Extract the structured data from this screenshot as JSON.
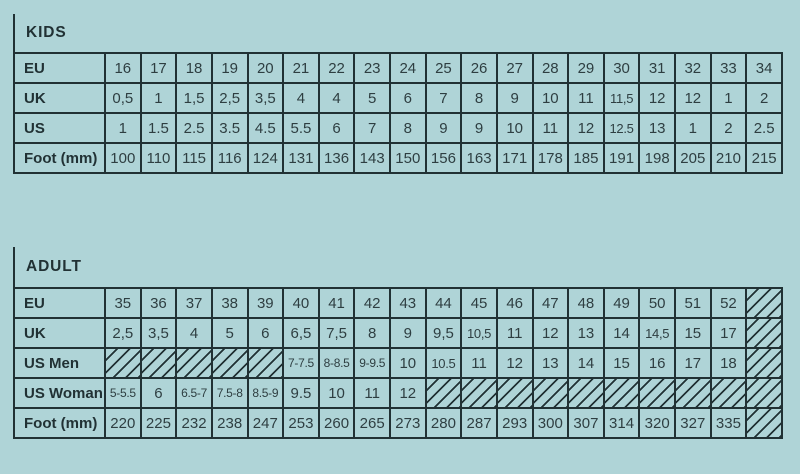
{
  "page": {
    "background_color": "#afd4d7",
    "ink_color": "#213134",
    "number_color": "#2e3e41",
    "hatch_pattern": "diagonal-lines"
  },
  "chart_data": [
    {
      "type": "table",
      "title": "KIDS",
      "rows": [
        {
          "label": "EU",
          "cells": [
            "16",
            "17",
            "18",
            "19",
            "20",
            "21",
            "22",
            "23",
            "24",
            "25",
            "26",
            "27",
            "28",
            "29",
            "30",
            "31",
            "32",
            "33",
            "34"
          ]
        },
        {
          "label": "UK",
          "cells": [
            "0,5",
            "1",
            "1,5",
            "2,5",
            "3,5",
            "4",
            "4",
            "5",
            "6",
            "7",
            "8",
            "9",
            "10",
            "11",
            "11,5",
            "12",
            "12",
            "1",
            "2"
          ]
        },
        {
          "label": "US",
          "cells": [
            "1",
            "1.5",
            "2.5",
            "3.5",
            "4.5",
            "5.5",
            "6",
            "7",
            "8",
            "9",
            "9",
            "10",
            "11",
            "12",
            "12.5",
            "13",
            "1",
            "2",
            "2.5"
          ]
        },
        {
          "label": "Foot (mm)",
          "cells": [
            "100",
            "110",
            "115",
            "116",
            "124",
            "131",
            "136",
            "143",
            "150",
            "156",
            "163",
            "171",
            "178",
            "185",
            "191",
            "198",
            "205",
            "210",
            "215"
          ]
        }
      ]
    },
    {
      "type": "table",
      "title": "ADULT",
      "rows": [
        {
          "label": "EU",
          "cells": [
            "35",
            "36",
            "37",
            "38",
            "39",
            "40",
            "41",
            "42",
            "43",
            "44",
            "45",
            "46",
            "47",
            "48",
            "49",
            "50",
            "51",
            "52",
            {
              "hatch": true
            }
          ]
        },
        {
          "label": "UK",
          "cells": [
            "2,5",
            "3,5",
            "4",
            "5",
            "6",
            "6,5",
            "7,5",
            "8",
            "9",
            "9,5",
            "10,5",
            "11",
            "12",
            "13",
            "14",
            "14,5",
            "15",
            "17",
            {
              "hatch": true
            }
          ]
        },
        {
          "label": "US Men",
          "cells": [
            {
              "hatch": true
            },
            {
              "hatch": true
            },
            {
              "hatch": true
            },
            {
              "hatch": true
            },
            {
              "hatch": true
            },
            "7-7.5",
            "8-8.5",
            "9-9.5",
            "10",
            "10.5",
            "11",
            "12",
            "13",
            "14",
            "15",
            "16",
            "17",
            "18",
            {
              "hatch": true
            }
          ]
        },
        {
          "label": "US Woman",
          "cells": [
            "5-5.5",
            "6",
            "6.5-7",
            "7.5-8",
            "8.5-9",
            "9.5",
            "10",
            "11",
            "12",
            {
              "hatch": true
            },
            {
              "hatch": true
            },
            {
              "hatch": true
            },
            {
              "hatch": true
            },
            {
              "hatch": true
            },
            {
              "hatch": true
            },
            {
              "hatch": true
            },
            {
              "hatch": true
            },
            {
              "hatch": true
            },
            {
              "hatch": true
            }
          ]
        },
        {
          "label": "Foot (mm)",
          "cells": [
            "220",
            "225",
            "232",
            "238",
            "247",
            "253",
            "260",
            "265",
            "273",
            "280",
            "287",
            "293",
            "300",
            "307",
            "314",
            "320",
            "327",
            "335",
            {
              "hatch": true
            }
          ]
        }
      ]
    }
  ]
}
